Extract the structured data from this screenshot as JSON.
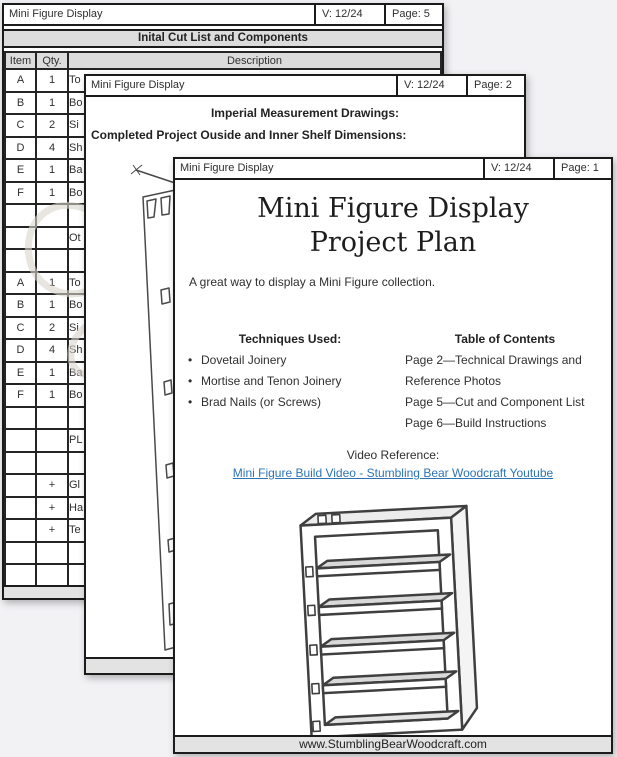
{
  "colors": {
    "background": "#f2f1f4",
    "page_border": "#1b1b1b",
    "gray_fill": "#dcdcdc",
    "footer_fill": "#e3e3e3",
    "link_blue": "#2e74b5"
  },
  "page5": {
    "header": {
      "title": "Mini Figure Display",
      "version": "V: 12/24",
      "page": "Page: 5"
    },
    "banner": "Inital Cut List and Components",
    "table": {
      "columns": {
        "item": "Item",
        "qty": "Qty.",
        "desc": "Description"
      },
      "rows": [
        {
          "item": "A",
          "qty": "1",
          "desc": "To"
        },
        {
          "item": "B",
          "qty": "1",
          "desc": "Bo"
        },
        {
          "item": "C",
          "qty": "2",
          "desc": "Si"
        },
        {
          "item": "D",
          "qty": "4",
          "desc": "Sh"
        },
        {
          "item": "E",
          "qty": "1",
          "desc": "Ba"
        },
        {
          "item": "F",
          "qty": "1",
          "desc": "Bo"
        },
        {
          "item": "",
          "qty": "",
          "desc": ""
        },
        {
          "item": "",
          "qty": "",
          "desc": "Ot"
        },
        {
          "item": "",
          "qty": "",
          "desc": ""
        },
        {
          "item": "A",
          "qty": "1",
          "desc": "To"
        },
        {
          "item": "B",
          "qty": "1",
          "desc": "Bo"
        },
        {
          "item": "C",
          "qty": "2",
          "desc": "Si"
        },
        {
          "item": "D",
          "qty": "4",
          "desc": "Sh"
        },
        {
          "item": "E",
          "qty": "1",
          "desc": "Ba"
        },
        {
          "item": "F",
          "qty": "1",
          "desc": "Bo"
        },
        {
          "item": "",
          "qty": "",
          "desc": ""
        },
        {
          "item": "",
          "qty": "",
          "desc": "PL"
        },
        {
          "item": "",
          "qty": "",
          "desc": ""
        },
        {
          "item": "",
          "qty": "+",
          "desc": "Gl"
        },
        {
          "item": "",
          "qty": "+",
          "desc": "Ha"
        },
        {
          "item": "",
          "qty": "+",
          "desc": "Te"
        },
        {
          "item": "",
          "qty": "",
          "desc": ""
        },
        {
          "item": "",
          "qty": "",
          "desc": ""
        }
      ]
    }
  },
  "page2": {
    "header": {
      "title": "Mini Figure Display",
      "version": "V: 12/24",
      "page": "Page: 2"
    },
    "heading_center": "Imperial Measurement Drawings:",
    "heading_left": "Completed Project Ouside and Inner Shelf Dimensions:"
  },
  "page1": {
    "header": {
      "title": "Mini Figure Display",
      "version": "V: 12/24",
      "page": "Page: 1"
    },
    "title_line1": "Mini Figure Display",
    "title_line2": "Project Plan",
    "intro": "A great way to display a Mini Figure collection.",
    "techniques": {
      "heading": "Techniques Used:",
      "items": [
        "Dovetail Joinery",
        "Mortise and Tenon Joinery",
        "Brad Nails (or Screws)"
      ]
    },
    "toc": {
      "heading": "Table of Contents",
      "lines": [
        "Page 2—Technical Drawings and",
        "Reference Photos",
        "Page 5—Cut and Component List",
        "Page 6—Build Instructions"
      ]
    },
    "video": {
      "label": "Video Reference:",
      "link": "Mini Figure Build Video - Stumbling Bear Woodcraft Youtube"
    },
    "footer": "www.StumblingBearWoodcraft.com"
  }
}
